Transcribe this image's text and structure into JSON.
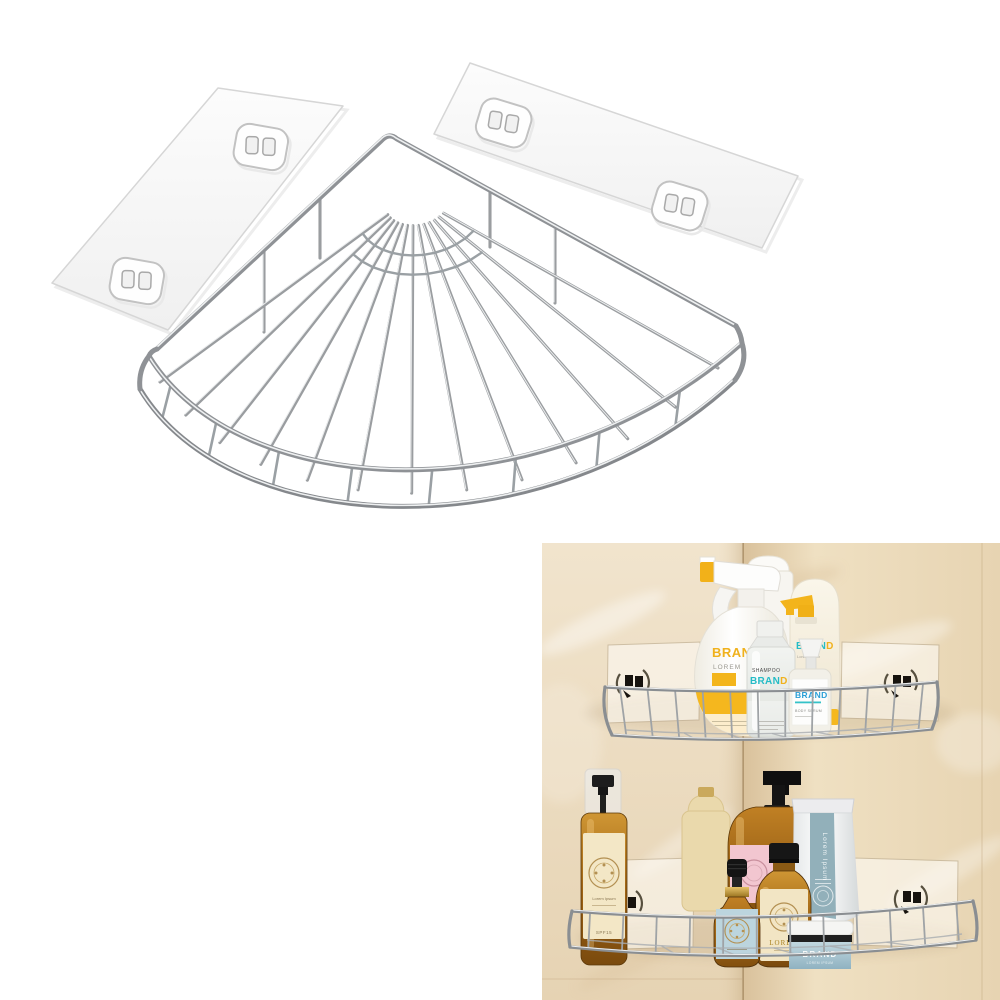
{
  "image": {
    "type": "product-photo",
    "background": "#ffffff"
  },
  "colors": {
    "chrome": "#97999c",
    "chrome_highlight": "#eceeee",
    "pad_fill": "#fafafa",
    "pad_stroke": "#d6d6d6",
    "wall_beige": "#ecdfc6",
    "wall_shadow": "#c9b28c",
    "corner_line": "#9b7d55",
    "accent_yellow": "#f3b51c",
    "accent_teal": "#25bcc6",
    "accent_blue": "#2b9fd6",
    "accent_green": "#8fc641",
    "amber": "#b5771c",
    "amber_dark": "#7a4a0e",
    "black": "#161616",
    "cream_label": "#f3e7c6",
    "pink_label": "#f2c6d0",
    "blue_label": "#bcd5de",
    "tube_stripe": "#92b0ba",
    "jar_blue": "#a5c3cf"
  },
  "main_render": {
    "subject": "corner-wire-shelf",
    "left_pad": "adhesive-sticker-pad",
    "right_pad": "adhesive-sticker-pad",
    "hook_plate": "wall-hook-plate"
  },
  "inset": {
    "scene": "bathroom-corner-with-two-shelves",
    "top_shelf": {
      "spray_bottle": {
        "brand": "BRAND",
        "line2": "LOREM"
      },
      "shampoo_bottle": {
        "line1": "SHAMPOO",
        "brand_a": "BRAN",
        "brand_b": "D"
      },
      "pump_bottle": {
        "brand_a": "BRAN",
        "brand_b": "D",
        "line2": "Lorem ipsum"
      },
      "serum_bottle": {
        "brand": "BRAND",
        "line2": "BODY SERUM"
      }
    },
    "bottom_shelf": {
      "amber_spray": {
        "line1": "Lorem Ipsum",
        "line2": "SPF15"
      },
      "tube": {
        "label": "Lorem Ipsum"
      },
      "amber_bottle": {
        "label": "LOREM"
      },
      "jar": {
        "brand": "BRAND",
        "line2": "LOREM IPSUM"
      }
    }
  }
}
